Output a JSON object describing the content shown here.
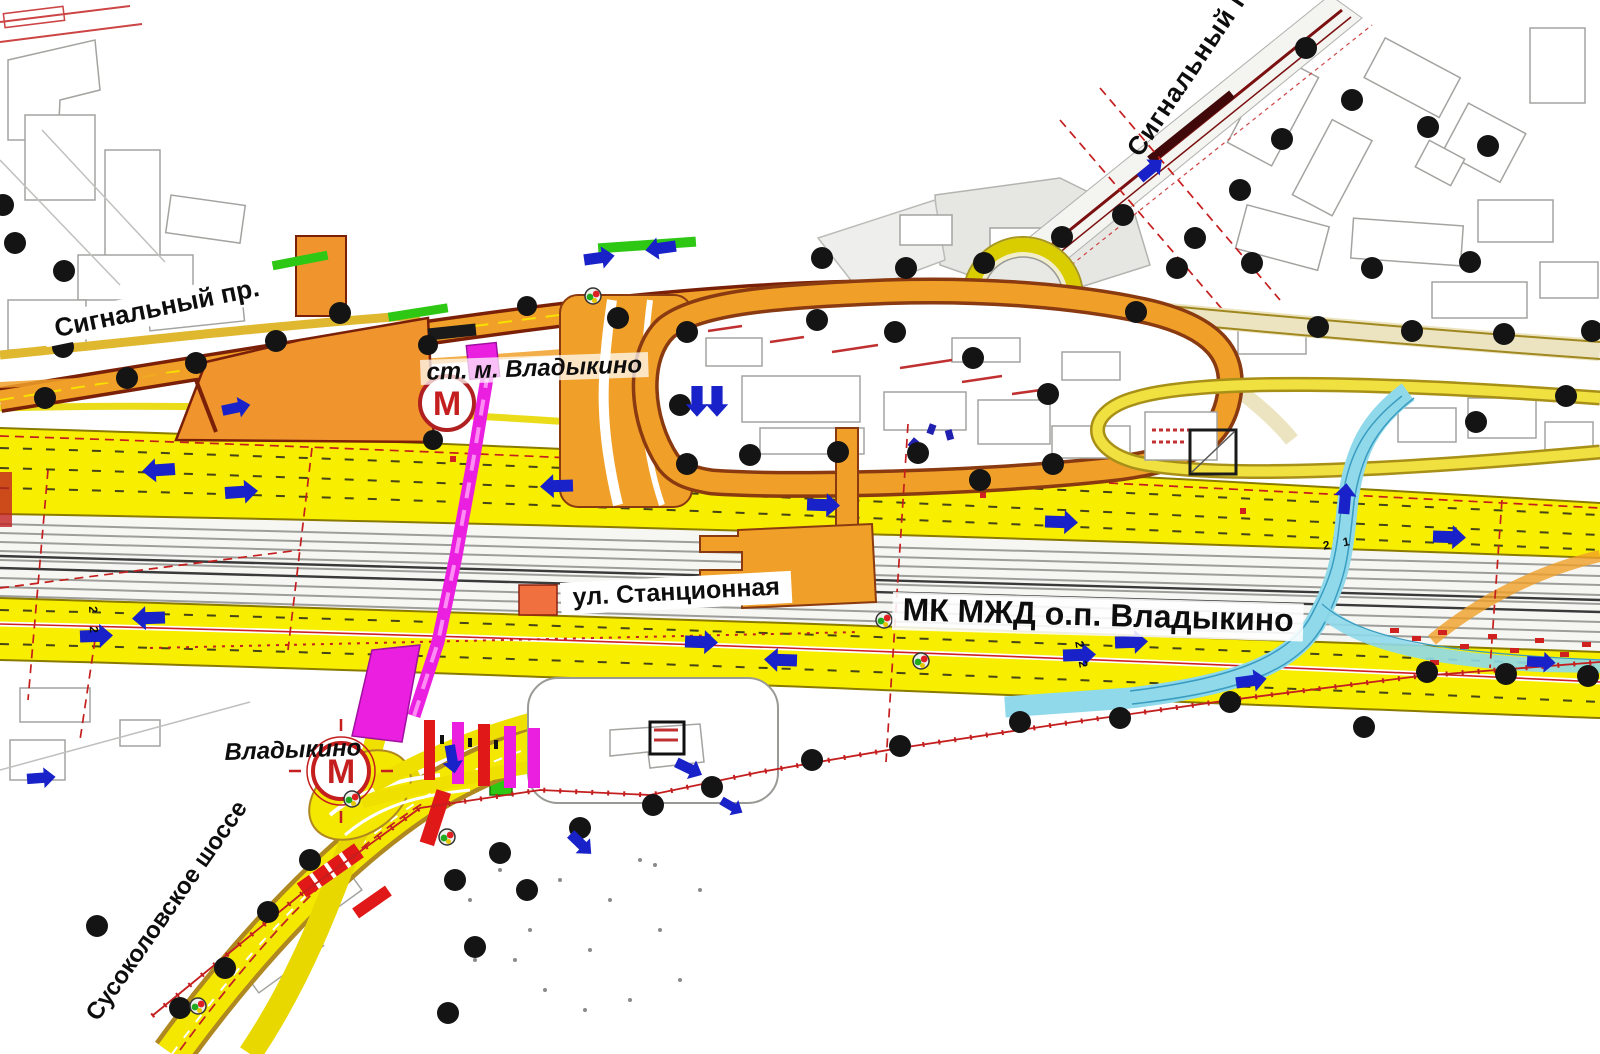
{
  "labels": {
    "signalny_top": "Сигнальный пр.",
    "signalny_left": "Сигнальный пр.",
    "metro_station_north": "ст. м. Владыкино",
    "stantsionnaya_street": "ул. Станционная",
    "mcc_stop": "МК МЖД о.п. Владыкино",
    "metro_station_south": "Владыкино",
    "susokolovskoe_highway": "Сусоколовское шоссе",
    "track_number_21": "2 1",
    "track_number_22_west": "2 2",
    "track_number_22_east": "2 2"
  },
  "icons": {
    "metro_symbol": "М"
  },
  "colors": {
    "road_yellow": "#f8ef00",
    "road_orange": "#f0a028",
    "road_dark_outline": "#8a3a10",
    "overpass_magenta": "#ea1fe0",
    "flyover_cyan": "#8fd9ea",
    "boundary_red": "#c41e1e",
    "rail_gray": "#9d9d9a",
    "survey_marker_black": "#141414",
    "metro_red": "#c41e1e",
    "arrow_blue": "#1822c8",
    "green_strip": "#2ec814"
  }
}
